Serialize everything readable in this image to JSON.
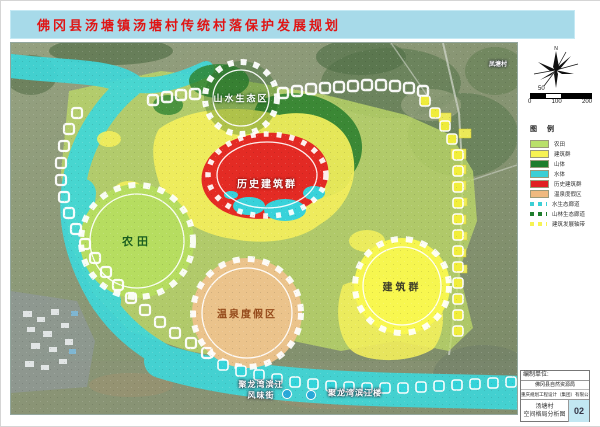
{
  "title": "佛冈县汤塘镇汤塘村传统村落保护发展规划",
  "map": {
    "zones": {
      "eco": "山水生态区",
      "historic": "历史建筑群",
      "farmland": "农田",
      "hotspring": "温泉度假区",
      "buildings": "建筑群"
    },
    "places": {
      "left1": "聚龙湾滨江",
      "left2": "风味街",
      "right": "聚龙湾滨江楼",
      "topright": "凤塘村"
    }
  },
  "sidebar": {
    "north_label": "N",
    "scale": {
      "above": "50",
      "ticks": [
        "0",
        "100",
        "200"
      ]
    },
    "legend": {
      "title": "图 例",
      "items": [
        {
          "label": "农田",
          "color": "#b9e06a",
          "type": "box"
        },
        {
          "label": "建筑群",
          "color": "#f6f353",
          "type": "box"
        },
        {
          "label": "山体",
          "color": "#1f7d2c",
          "type": "box"
        },
        {
          "label": "水体",
          "color": "#3ccfd5",
          "type": "box"
        },
        {
          "label": "历史建筑群",
          "color": "#e02020",
          "type": "box"
        },
        {
          "label": "温泉度假区",
          "color": "#efb97f",
          "type": "box"
        },
        {
          "label": "水生态廊道",
          "color": "#3ccfd5",
          "type": "dots"
        },
        {
          "label": "山林生态廊道",
          "color": "#1f7d2c",
          "type": "dots"
        },
        {
          "label": "建筑发展轴带",
          "color": "#f6f353",
          "type": "dots"
        }
      ]
    },
    "info": {
      "unit_label": "编制单位:",
      "unit1": "佛冈县自然资源局",
      "unit2": "重庆规划工程设计（集团）有限公司",
      "plate1": "汤塘村",
      "plate2": "空间格局分析图",
      "page_no": "02"
    }
  },
  "colors": {
    "title_bar": "#a7dae9",
    "title_text": "#e01515",
    "river": "#3fd7d9",
    "plan_area": "#bcd968",
    "mountain": "#2a7e2e",
    "historic_red": "#e32222",
    "resort_orange": "#ecc28c",
    "buildings_yellow": "#f8f74e",
    "page_badge_bg": "#c2e7f2"
  }
}
